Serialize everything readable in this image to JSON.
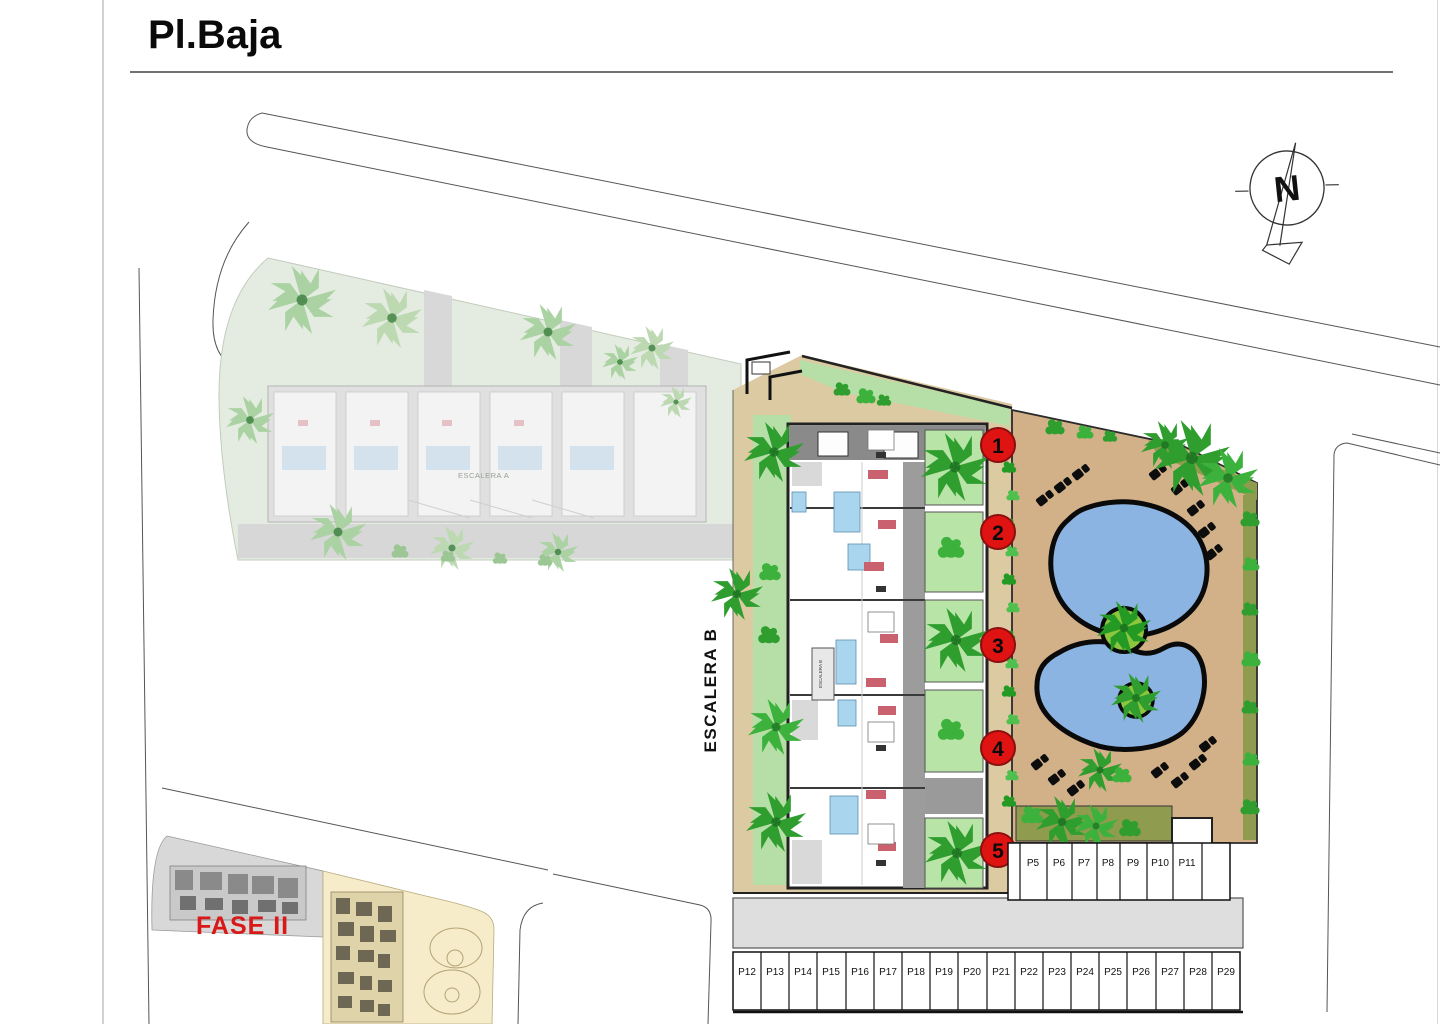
{
  "page": {
    "title": "Pl.Baja"
  },
  "compass": {
    "north_label": "N"
  },
  "plan": {
    "stair_b_label": "ESCALERA B",
    "stair_b_core_label": "ESCALERA B",
    "stair_a_label": "ESCALERA A",
    "phase_label": "FASE II",
    "unit_markers": [
      "1",
      "2",
      "3",
      "4",
      "5"
    ]
  },
  "parking": {
    "top_row": [
      "P5",
      "P6",
      "P7",
      "P8",
      "P9",
      "P10",
      "P11"
    ],
    "bottom_row": [
      "P12",
      "P13",
      "P14",
      "P15",
      "P16",
      "P17",
      "P18",
      "P19",
      "P20",
      "P21",
      "P22",
      "P23",
      "P24",
      "P25",
      "P26",
      "P27",
      "P28",
      "P29"
    ]
  },
  "colors": {
    "marker_red": "#e01313",
    "pool_blue": "#8cb4e2",
    "deck_tan": "#d2b189",
    "path_tan": "#dccaa3",
    "lawn_green": "#b6dfa7",
    "tree_green": "#2f9e2f",
    "hedge_olive": "#8f9b4f",
    "phase_red": "#d91818"
  }
}
